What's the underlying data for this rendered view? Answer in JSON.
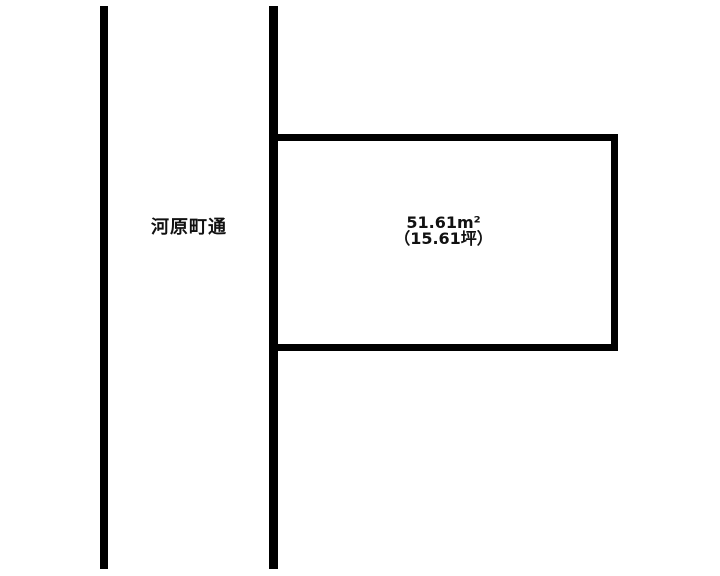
{
  "diagram": {
    "title": "land-parcel-site-plan",
    "street": {
      "label": "河原町通"
    },
    "parcel": {
      "area_sqm": "51.61m²",
      "area_tsubo": "（15.61坪）"
    },
    "colors": {
      "line": "#000000",
      "background": "#ffffff",
      "text": "#111111"
    }
  }
}
